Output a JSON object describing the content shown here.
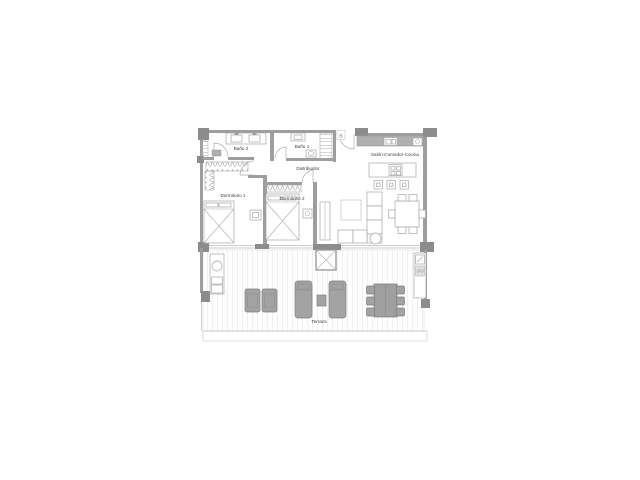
{
  "document": {
    "type": "apartment-floor-plan",
    "background": "#ffffff"
  },
  "plan": {
    "marker": {
      "label": "B"
    },
    "rooms": {
      "bano2": {
        "label": "Baño 2"
      },
      "bano1": {
        "label": "Baño 1"
      },
      "distribuidor": {
        "label": "Distribuidor"
      },
      "dormitorio1": {
        "label": "Dormitorio 1"
      },
      "dormitorio2": {
        "label": "Dormitorio 2"
      },
      "salon": {
        "label": "Salón-Comedor-Cocina"
      },
      "terraza": {
        "label": "Terraza"
      }
    },
    "colors": {
      "wall": "#9e9e9e",
      "pier": "#8c8c8c",
      "furniture_outline": "#a6a6a6",
      "terrace_furniture_fill": "#a3a3a3",
      "terrace_furniture_stroke": "#7d7d7d",
      "label_text": "#3c3c3c"
    }
  }
}
